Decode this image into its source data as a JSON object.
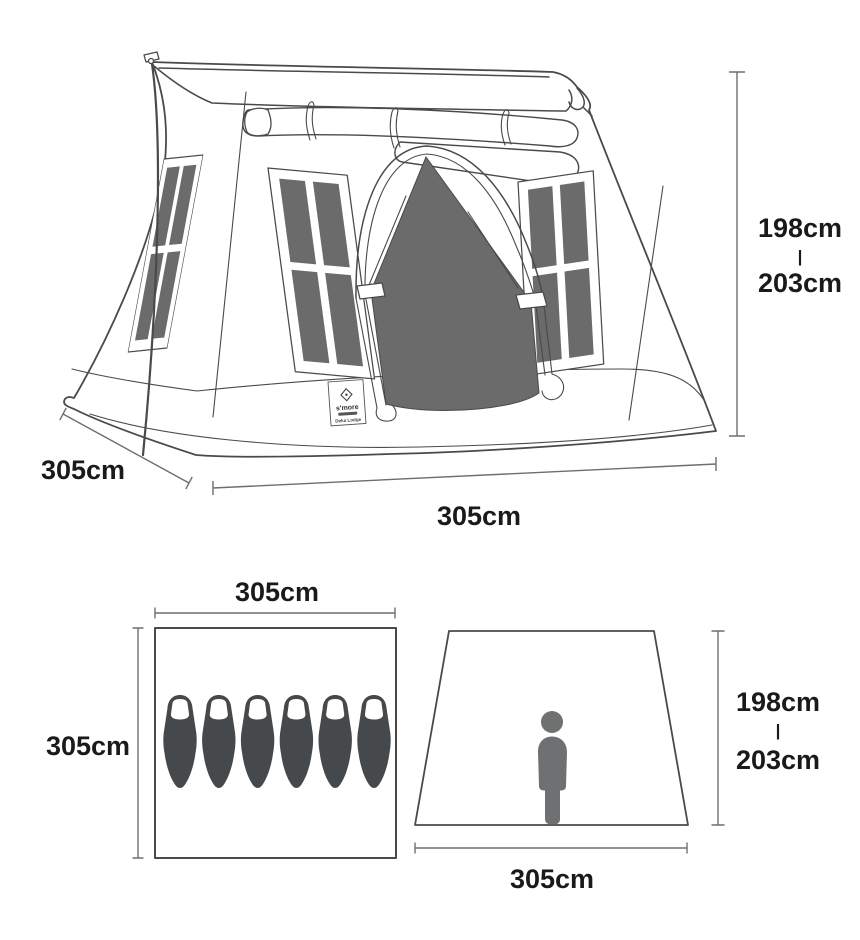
{
  "perspective_view": {
    "height": {
      "top": "198cm",
      "separator": "|",
      "bottom": "203cm"
    },
    "depth_label": "305cm",
    "width_label": "305cm",
    "brand_label": {
      "brand": "s'more",
      "product": "Deka Lodge"
    }
  },
  "floor_plan": {
    "width_label": "305cm",
    "depth_label": "305cm",
    "sleeping_bag_count": 6
  },
  "front_elevation": {
    "height": {
      "top": "198cm",
      "separator": "|",
      "bottom": "203cm"
    },
    "width_label": "305cm"
  },
  "colors": {
    "line": "#4a4a4a",
    "dim_line": "#6e6e6e",
    "dark_fill": "#6b6b6b",
    "bag_fill": "#46494c",
    "person_fill": "#6f7071",
    "text": "#1a1a1a",
    "background": "#ffffff"
  }
}
